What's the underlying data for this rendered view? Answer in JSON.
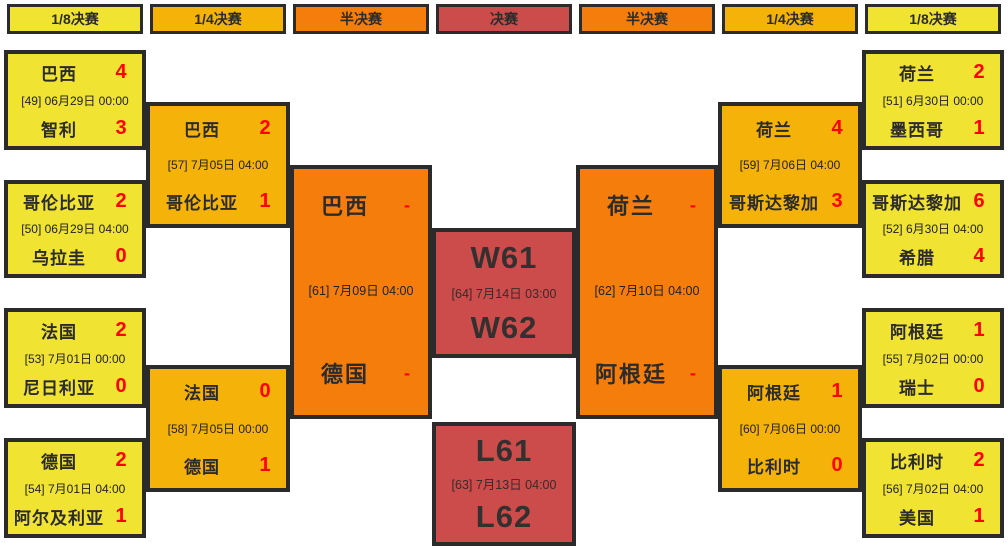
{
  "colors": {
    "round_of_16": "#F0E331",
    "quarterfinal": "#F5B30A",
    "semifinal": "#F57D0C",
    "final": "#CC4B4B",
    "border": "#2b2b2b",
    "score_red": "#FF0000",
    "team_text": "#2b2b2b",
    "background": "#FFFFFF"
  },
  "headers": [
    {
      "label": "1/8决赛"
    },
    {
      "label": "1/4决赛"
    },
    {
      "label": "半决赛"
    },
    {
      "label": "决赛"
    },
    {
      "label": "半决赛"
    },
    {
      "label": "1/4决赛"
    },
    {
      "label": "1/8决赛"
    }
  ],
  "matches": {
    "m49": {
      "team1": "巴西",
      "score1": "4",
      "date": "[49] 06月29日 00:00",
      "team2": "智利",
      "score2": "3"
    },
    "m50": {
      "team1": "哥伦比亚",
      "score1": "2",
      "date": "[50] 06月29日 04:00",
      "team2": "乌拉圭",
      "score2": "0"
    },
    "m53": {
      "team1": "法国",
      "score1": "2",
      "date": "[53] 7月01日 00:00",
      "team2": "尼日利亚",
      "score2": "0"
    },
    "m54": {
      "team1": "德国",
      "score1": "2",
      "date": "[54] 7月01日 04:00",
      "team2": "阿尔及利亚",
      "score2": "1"
    },
    "m57": {
      "team1": "巴西",
      "score1": "2",
      "date": "[57] 7月05日 04:00",
      "team2": "哥伦比亚",
      "score2": "1"
    },
    "m58": {
      "team1": "法国",
      "score1": "0",
      "date": "[58] 7月05日 00:00",
      "team2": "德国",
      "score2": "1"
    },
    "m61": {
      "team1": "巴西",
      "score1": "-",
      "date": "[61] 7月09日 04:00",
      "team2": "德国",
      "score2": "-"
    },
    "m64": {
      "team1": "W61",
      "date": "[64] 7月14日 03:00",
      "team2": "W62"
    },
    "m63": {
      "team1": "L61",
      "date": "[63] 7月13日 04:00",
      "team2": "L62"
    },
    "m62": {
      "team1": "荷兰",
      "score1": "-",
      "date": "[62] 7月10日 04:00",
      "team2": "阿根廷",
      "score2": "-"
    },
    "m59": {
      "team1": "荷兰",
      "score1": "4",
      "date": "[59] 7月06日 04:00",
      "team2": "哥斯达黎加",
      "score2": "3"
    },
    "m60": {
      "team1": "阿根廷",
      "score1": "1",
      "date": "[60] 7月06日 00:00",
      "team2": "比利时",
      "score2": "0"
    },
    "m51": {
      "team1": "荷兰",
      "score1": "2",
      "date": "[51] 6月30日 00:00",
      "team2": "墨西哥",
      "score2": "1"
    },
    "m52": {
      "team1": "哥斯达黎加",
      "score1": "6",
      "date": "[52] 6月30日 04:00",
      "team2": "希腊",
      "score2": "4"
    },
    "m55": {
      "team1": "阿根廷",
      "score1": "1",
      "date": "[55] 7月02日 00:00",
      "team2": "瑞士",
      "score2": "0"
    },
    "m56": {
      "team1": "比利时",
      "score1": "2",
      "date": "[56] 7月02日 04:00",
      "team2": "美国",
      "score2": "1"
    }
  }
}
